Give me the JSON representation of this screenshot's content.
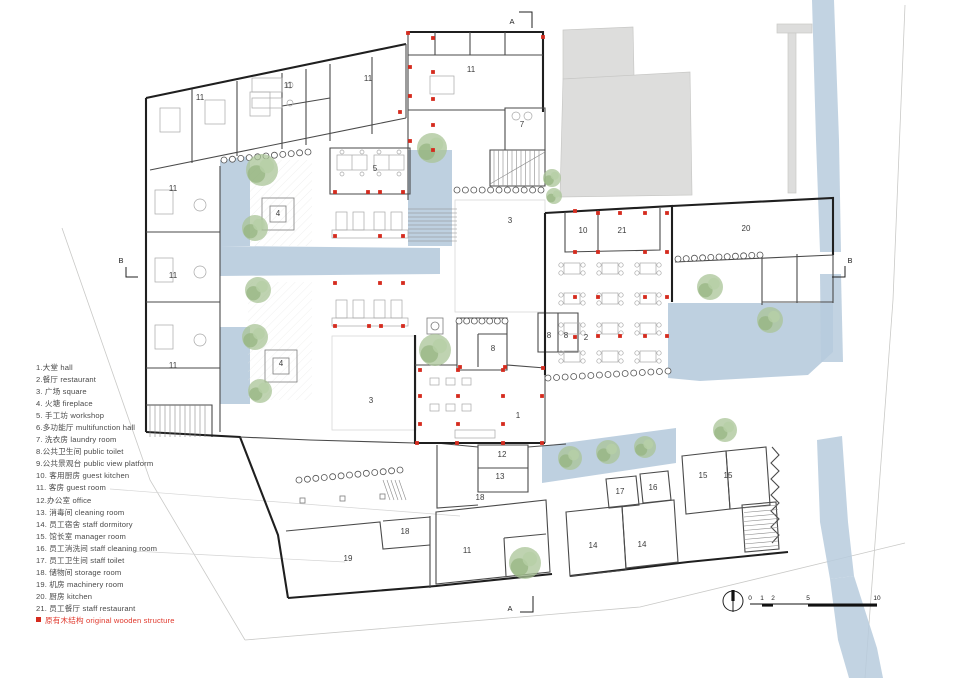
{
  "legend": {
    "items": [
      "1.大堂 hall",
      "2.餐厅 restaurant",
      "3. 广场 square",
      "4. 火塘 fireplace",
      "5. 手工坊 workshop",
      "6.多功能厅 multifunction hall",
      "7. 洗衣房 laundry room",
      "8.公共卫生间 public toilet",
      "9.公共景观台 public view platform",
      "10. 客用厨房 guest kitchen",
      "11. 客房 guest room",
      "12.办公室 office",
      "13. 消毒间 cleaning room",
      "14. 员工宿舍 staff dormitory",
      "15. 馆长室 manager room",
      "16. 员工消洗间 staff cleaning room",
      "17. 员工卫生间 staff toilet",
      "18. 储物间 storage room",
      "19. 机房 machinery room",
      "20. 厨房 kitchen",
      "21. 员工餐厅 staff restaurant"
    ],
    "note": "原有木结构 original wooden structure"
  },
  "plan": {
    "room_labels": [
      {
        "t": "11",
        "x": 200,
        "y": 100
      },
      {
        "t": "11",
        "x": 288,
        "y": 88
      },
      {
        "t": "11",
        "x": 368,
        "y": 81
      },
      {
        "t": "11",
        "x": 471,
        "y": 72
      },
      {
        "t": "11",
        "x": 173,
        "y": 191
      },
      {
        "t": "11",
        "x": 173,
        "y": 278
      },
      {
        "t": "11",
        "x": 173,
        "y": 368
      },
      {
        "t": "11",
        "x": 467,
        "y": 553
      },
      {
        "t": "7",
        "x": 522,
        "y": 127
      },
      {
        "t": "5",
        "x": 375,
        "y": 171
      },
      {
        "t": "4",
        "x": 278,
        "y": 216
      },
      {
        "t": "4",
        "x": 281,
        "y": 366
      },
      {
        "t": "3",
        "x": 510,
        "y": 223
      },
      {
        "t": "3",
        "x": 371,
        "y": 403
      },
      {
        "t": "10",
        "x": 583,
        "y": 233
      },
      {
        "t": "21",
        "x": 622,
        "y": 233
      },
      {
        "t": "20",
        "x": 746,
        "y": 231
      },
      {
        "t": "2",
        "x": 586,
        "y": 340
      },
      {
        "t": "8",
        "x": 493,
        "y": 351
      },
      {
        "t": "8",
        "x": 549,
        "y": 338
      },
      {
        "t": "8",
        "x": 566,
        "y": 338
      },
      {
        "t": "1",
        "x": 518,
        "y": 418
      },
      {
        "t": "12",
        "x": 502,
        "y": 457
      },
      {
        "t": "13",
        "x": 500,
        "y": 479
      },
      {
        "t": "18",
        "x": 480,
        "y": 500
      },
      {
        "t": "18",
        "x": 405,
        "y": 534
      },
      {
        "t": "19",
        "x": 348,
        "y": 561
      },
      {
        "t": "14",
        "x": 593,
        "y": 548
      },
      {
        "t": "14",
        "x": 642,
        "y": 547
      },
      {
        "t": "15",
        "x": 703,
        "y": 478
      },
      {
        "t": "15",
        "x": 728,
        "y": 478
      },
      {
        "t": "16",
        "x": 653,
        "y": 490
      },
      {
        "t": "17",
        "x": 620,
        "y": 494
      }
    ],
    "sections": [
      {
        "label": "A",
        "x": 512,
        "y": 24,
        "path": "M519,12 L532,12 L532,28"
      },
      {
        "label": "A",
        "x": 510,
        "y": 611,
        "path": "M520,612 L533,612 L533,596"
      },
      {
        "label": "B",
        "x": 121,
        "y": 263,
        "path": "M126,267 L126,277 L138,277"
      },
      {
        "label": "B",
        "x": 850,
        "y": 263,
        "path": "M845,266 L845,277 L832,277"
      }
    ],
    "wooden_dots": [
      [
        433,
        38
      ],
      [
        408,
        33
      ],
      [
        543,
        37
      ],
      [
        410,
        67
      ],
      [
        433,
        72
      ],
      [
        410,
        96
      ],
      [
        433,
        99
      ],
      [
        400,
        112
      ],
      [
        433,
        125
      ],
      [
        410,
        141
      ],
      [
        433,
        150
      ],
      [
        335,
        192
      ],
      [
        368,
        192
      ],
      [
        380,
        192
      ],
      [
        403,
        192
      ],
      [
        335,
        236
      ],
      [
        380,
        236
      ],
      [
        403,
        236
      ],
      [
        335,
        283
      ],
      [
        380,
        283
      ],
      [
        403,
        283
      ],
      [
        335,
        326
      ],
      [
        369,
        326
      ],
      [
        381,
        326
      ],
      [
        403,
        326
      ],
      [
        460,
        367
      ],
      [
        505,
        367
      ],
      [
        543,
        368
      ],
      [
        575,
        211
      ],
      [
        575,
        252
      ],
      [
        575,
        297
      ],
      [
        575,
        337
      ],
      [
        598,
        213
      ],
      [
        620,
        213
      ],
      [
        645,
        213
      ],
      [
        667,
        213
      ],
      [
        598,
        252
      ],
      [
        645,
        252
      ],
      [
        667,
        252
      ],
      [
        598,
        297
      ],
      [
        645,
        297
      ],
      [
        667,
        297
      ],
      [
        598,
        336
      ],
      [
        620,
        336
      ],
      [
        645,
        336
      ],
      [
        667,
        336
      ],
      [
        420,
        370
      ],
      [
        458,
        370
      ],
      [
        503,
        370
      ],
      [
        420,
        396
      ],
      [
        458,
        396
      ],
      [
        503,
        396
      ],
      [
        542,
        396
      ],
      [
        420,
        424
      ],
      [
        458,
        424
      ],
      [
        503,
        424
      ],
      [
        417,
        443
      ],
      [
        457,
        443
      ],
      [
        503,
        443
      ],
      [
        542,
        443
      ]
    ],
    "trees": [
      [
        262,
        170,
        16
      ],
      [
        255,
        228,
        13
      ],
      [
        258,
        290,
        13
      ],
      [
        255,
        337,
        13
      ],
      [
        260,
        391,
        12
      ],
      [
        432,
        148,
        15
      ],
      [
        435,
        350,
        16
      ],
      [
        552,
        178,
        9
      ],
      [
        554,
        196,
        8
      ],
      [
        710,
        287,
        13
      ],
      [
        770,
        320,
        13
      ],
      [
        570,
        458,
        12
      ],
      [
        608,
        452,
        12
      ],
      [
        645,
        447,
        11
      ],
      [
        725,
        430,
        12
      ],
      [
        525,
        563,
        16
      ]
    ],
    "pools": [
      "220,160 250,156 250,246 220,246",
      "220,246 440,248 440,274 220,276",
      "220,327 250,327 250,404 220,404",
      "408,150 452,150 452,246 408,246",
      "668,303 833,303 833,352 808,375 700,381 668,378",
      "542,446 676,428 676,463 542,483"
    ],
    "river": [
      "812,0 834,0 839,140 841,252 820,252 816,140",
      "820,274 841,274 843,362 821,362",
      "817,440 842,436 848,522 854,576 830,579 820,522",
      "830,579 854,576 877,648 883,678 849,678 838,640"
    ]
  },
  "scalebar": {
    "labels": [
      "0",
      "1",
      "2",
      "5",
      "10"
    ]
  },
  "colors": {
    "water": "#b7cbdd",
    "wood_dot": "#d52b1e",
    "neighbor": "#dddddc",
    "tree": "#a9c497",
    "legend_note": "#e0392d"
  }
}
